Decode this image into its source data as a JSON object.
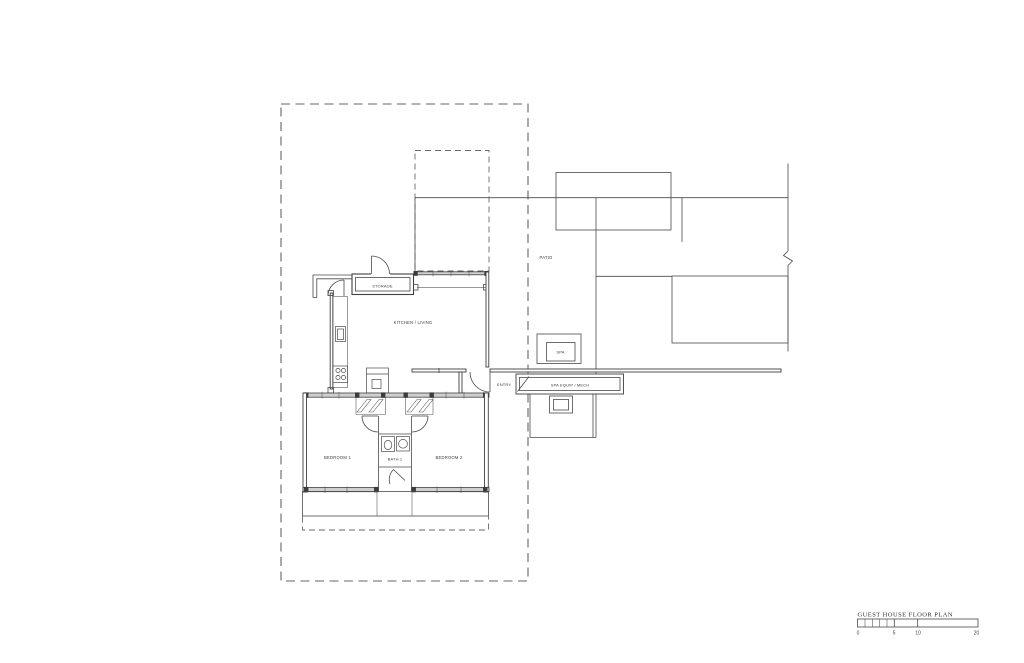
{
  "drawing": {
    "labels": {
      "storage": "STORAGE",
      "kitchen_living": "KITCHEN / LIVING",
      "patio": "PATIO",
      "spa": "SPA",
      "entry": "ENTRY",
      "spa_equip_mech": "SPA EQUIP / MECH",
      "bedroom_1": "BEDROOM 1",
      "bath_1": "BATH 1",
      "bedroom_2": "BEDROOM 2"
    },
    "title_block": {
      "title": "GUEST HOUSE FLOOR PLAN",
      "scale_labels": [
        "0",
        "5",
        "10",
        "20"
      ]
    },
    "colors": {
      "line": "#4a4a4a",
      "dashed_line": "#666666",
      "wall_fill": "#cfcfcf",
      "background": "#ffffff"
    }
  }
}
